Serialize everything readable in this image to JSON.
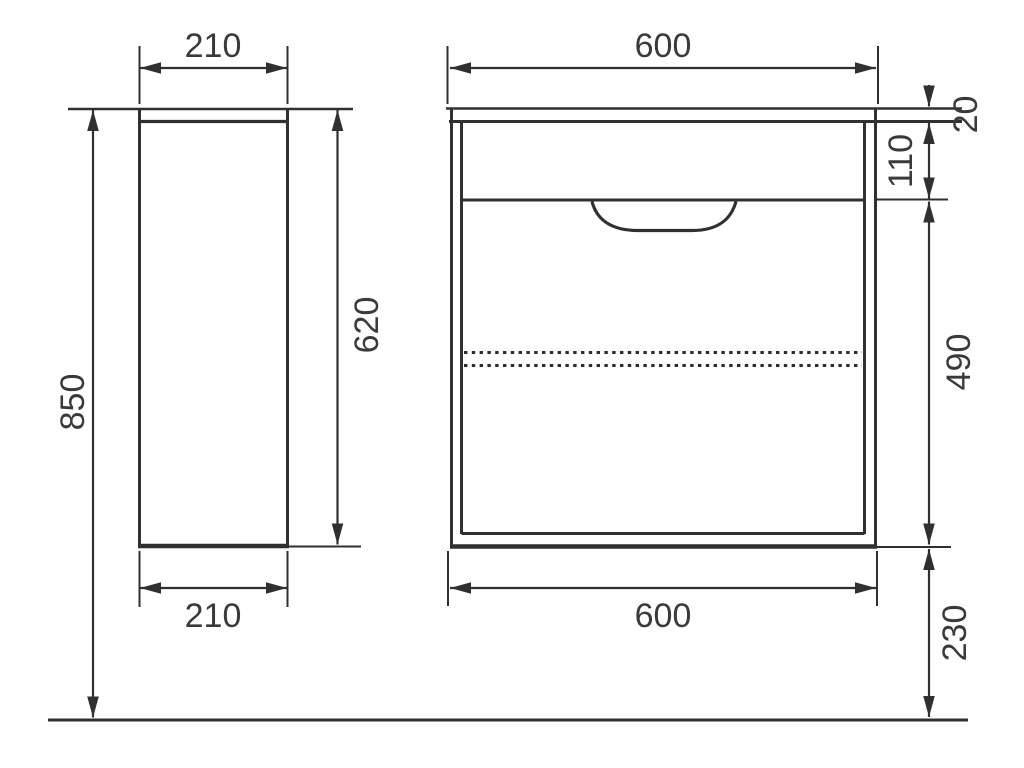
{
  "drawing": {
    "kind": "cabinet-dimension-drawing",
    "colors": {
      "line": "#303030",
      "text": "#3a3a3a",
      "background": "#ffffff"
    },
    "side_view": {
      "width_top": "210",
      "width_bottom": "210",
      "body_height": "620",
      "total_height": "850"
    },
    "front_view": {
      "width_top": "600",
      "width_bottom": "600",
      "top_panel_thickness": "20",
      "drawer_front_height": "110",
      "lower_section_height": "490",
      "floor_clearance": "230"
    }
  }
}
